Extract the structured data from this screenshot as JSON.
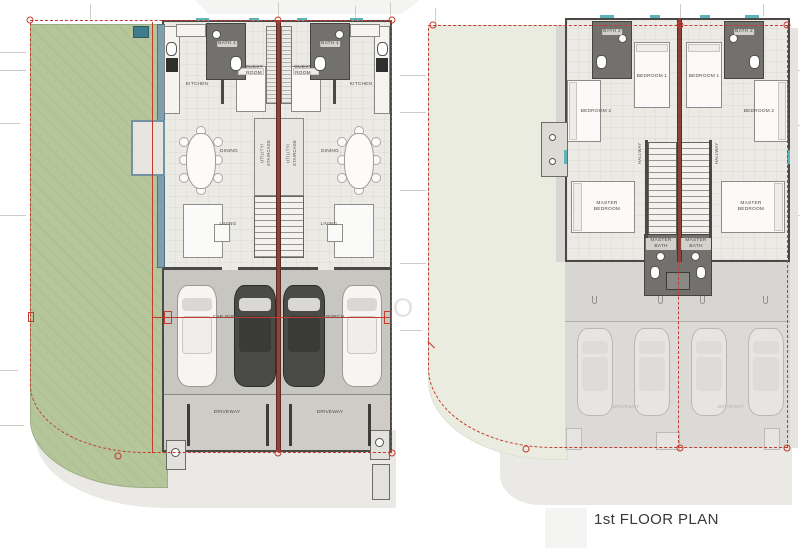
{
  "document": {
    "kind": "architectural floor plan sheet",
    "watermark": {
      "letter_o": "O",
      "letter_u": "U"
    }
  },
  "plans": {
    "ground_floor": {
      "rooms": {
        "kitchen": "KITCHEN",
        "bath1": "BATH 1",
        "guest_room": "GUEST ROOM",
        "dining": "DINING",
        "utility_staircase": "UTILITY/ STAIRCASE",
        "living": "LIVING",
        "car_porch": "CAR PORCH",
        "driveway": "DRIVEWAY"
      }
    },
    "first_floor": {
      "title": "1st FLOOR PLAN",
      "rooms": {
        "bath2": "BATH 2",
        "bedroom1": "BEDROOM 1",
        "bedroom2": "BEDROOM 2",
        "hallway": "HALLWAY",
        "master_bedroom": "MASTER BEDROOM",
        "master_bath": "MASTER BATH",
        "driveway": "DRIVEWAY"
      }
    }
  },
  "colors": {
    "garden_green": "#b5c69a",
    "garden_ghost": "#e9ecdf",
    "boundary_red": "#c23b2d",
    "party_wall_red": "#8d423b",
    "wall_dark": "#4a4947",
    "floor": "#eceae5",
    "car_porch_floor": "#c8c6c1",
    "driveway_floor": "#cfccc8",
    "bath_floor_dark": "#73716e",
    "window_teal": "#5cb3b8",
    "sidewalk": "#eae9e5"
  }
}
